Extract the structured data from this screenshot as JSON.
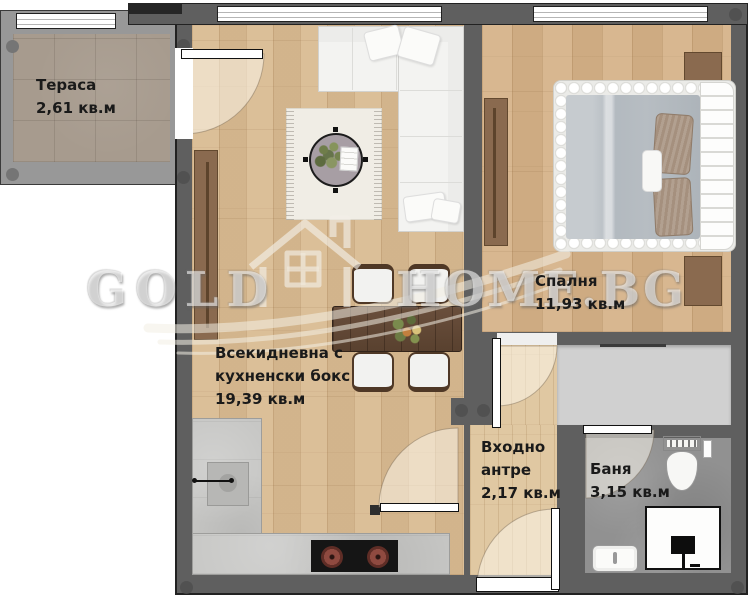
{
  "watermark": {
    "text_left": "GOLD",
    "text_right": "HOME.BG",
    "icon": "house-logo"
  },
  "rooms": {
    "terrace": {
      "name": "Тераса",
      "area": "2,61 кв.м"
    },
    "living_room": {
      "name_line1": "Всекидневна с",
      "name_line2": "кухненски бокс",
      "area": "19,39 кв.м"
    },
    "bedroom": {
      "name": "Спалня",
      "area": "11,93 кв.м"
    },
    "entry_hall": {
      "name_line1": "Входно",
      "name_line2": "антре",
      "area": "2,17 кв.м"
    },
    "bathroom": {
      "name": "Баня",
      "area": "3,15 кв.м"
    }
  },
  "colors": {
    "wall": "#5f5f5f",
    "terrace_wall": "#989898",
    "wood_living": "#d9bb92",
    "wood_bedroom": "#d5b288",
    "wood_hall": "#e0c8a2",
    "terrace_tile": "#a79b8e",
    "bath_tile": "#919191",
    "counter": "#c7c7c5",
    "furniture_wood": "#8a6a4f",
    "dining_table_wood": "#5f4736",
    "cooktop": "#151515",
    "burner": "#8f4a40",
    "duvet": "#b6bcc1",
    "label_text": "#1a1a1a",
    "watermark": "#ffffff"
  }
}
